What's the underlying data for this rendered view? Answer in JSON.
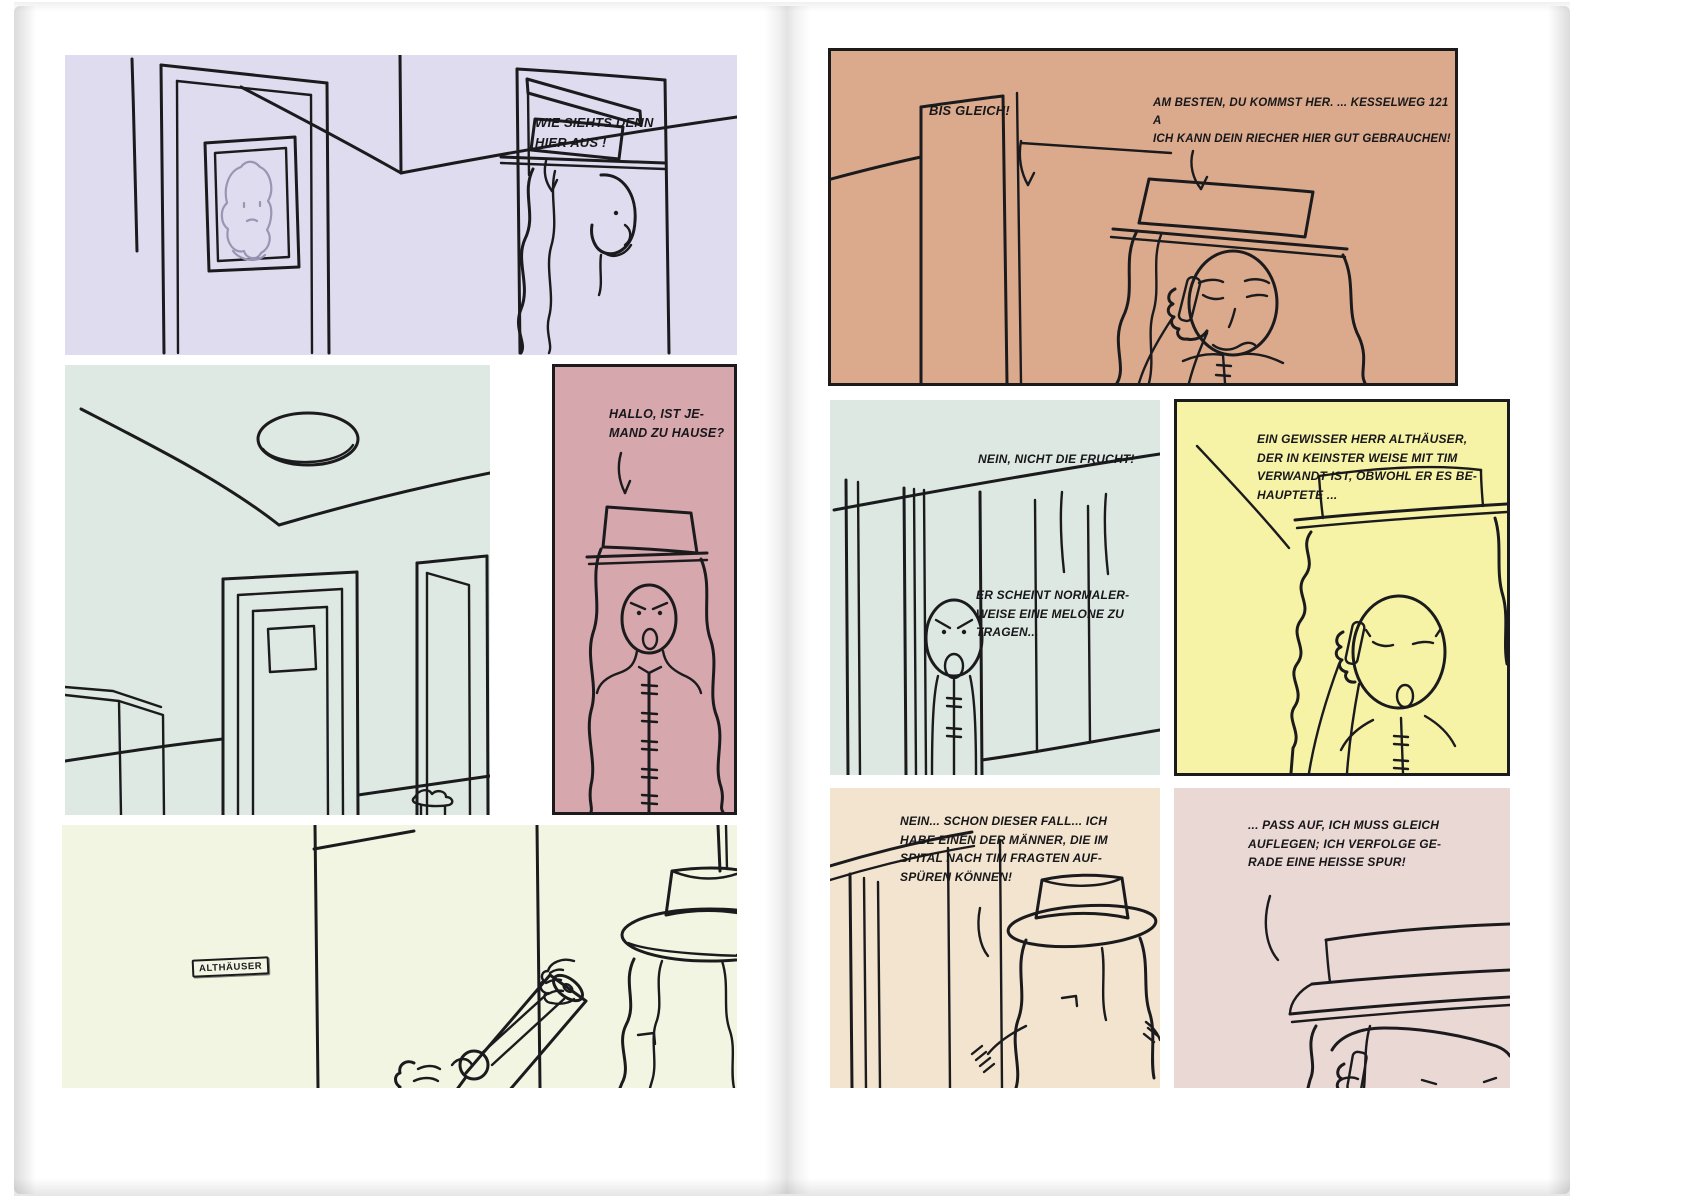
{
  "document": {
    "type": "comic-book-spread",
    "language": "German",
    "pages": 2
  },
  "colors": {
    "ink": "#1b1b1e",
    "paper": "#ffffff",
    "picture_face_stroke": "#9b95b4",
    "panel_l1_bg": "#dedcee",
    "panel_l2_bg": "#dee9e3",
    "panel_l3_bg": "#d6a7ac",
    "panel_l4_bg": "#f3f5e3",
    "panel_r1_bg": "#dbaa8d",
    "panel_r2_bg": "#dde8e2",
    "panel_r3_bg": "#f7f3a6",
    "panel_r4_bg": "#f2e4ce",
    "panel_r5_bg": "#ead8d4"
  },
  "panels": {
    "l1": {
      "scene": "hallway with picture and opening door",
      "bg": "#dedcee",
      "speech": "WIE SIEHTS DENN\nHIER AUS !"
    },
    "l2": {
      "scene": "empty corridor with ceiling lamp and doors",
      "bg": "#dee9e3"
    },
    "l3": {
      "scene": "woman with flat hat calling out",
      "bg": "#d6a7ac",
      "speech": "HALLO, IST JE-\nMAND ZU HAUSE?"
    },
    "l4": {
      "scene": "hand with pistol behind wall, figure with boater hat",
      "bg": "#f3f5e3",
      "nameplate": "ALTHÄUSER"
    },
    "r1": {
      "scene": "woman on the phone in doorway",
      "bg": "#dbaa8d",
      "speech_a": "BIS GLEICH!",
      "speech_b": "AM BESTEN, DU KOMMST HER. ... KESSELWEG 121 A\nICH KANN DEIN RIECHER HIER GUT GEBRAUCHEN!"
    },
    "r2": {
      "scene": "angry man peeking through sliding door",
      "bg": "#dde8e2",
      "speech_a": "NEIN, NICHT DIE FRUCHT!",
      "speech_b": "ER SCHEINT NORMALER-\nWEISE EINE MELONE ZU\nTRAGEN..."
    },
    "r3": {
      "scene": "woman on the phone, eyes closed",
      "bg": "#f7f3a6",
      "speech": "EIN GEWISSER HERR ALTHÄUSER,\nDER IN KEINSTER WEISE MIT TIM\nVERWANDT IST, OBWOHL ER ES BE-\nHAUPTETE ..."
    },
    "r4": {
      "scene": "figure with boater hat seen from behind",
      "bg": "#f2e4ce",
      "speech": "NEIN... SCHON DIESER FALL... ICH\nHABE EINEN DER MÄNNER, DIE IM\nSPITAL NACH TIM FRAGTEN AUF-\nSPÜREN KÖNNEN!"
    },
    "r5": {
      "scene": "close-up of face with hat brim and phone",
      "bg": "#ead8d4",
      "speech": "... PASS AUF, ICH MUSS GLEICH\nAUFLEGEN; ICH VERFOLGE GE-\nRADE EINE HEISSE SPUR!"
    }
  }
}
